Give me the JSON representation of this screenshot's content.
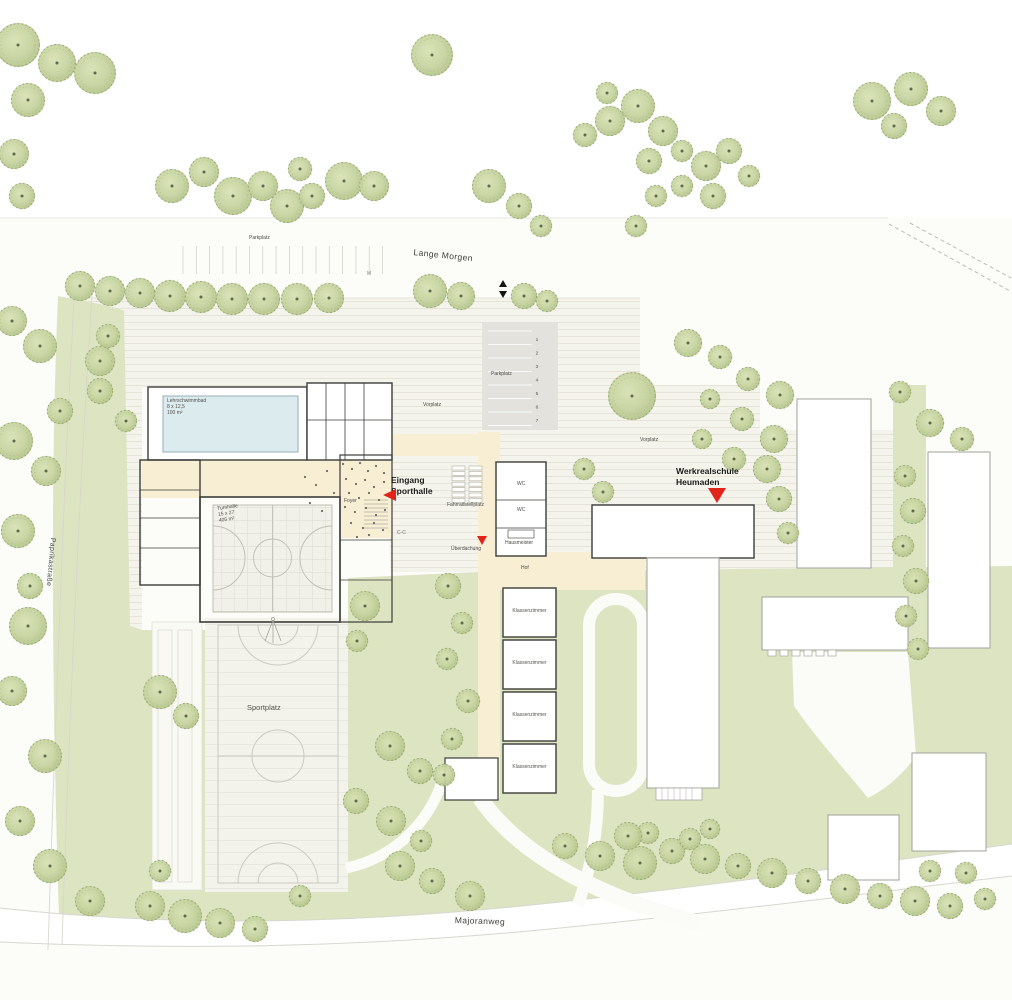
{
  "streets": {
    "top": "Lange Morgen",
    "left": "Paprikastraße",
    "bottom": "Majoranweg"
  },
  "areas": {
    "parking_top": "Parkplatz",
    "parking_school": "Parkplatz",
    "parking_stalls": [
      "1",
      "2",
      "3",
      "4",
      "5",
      "6",
      "7"
    ],
    "forecourt_west": "Vorplatz",
    "forecourt_east": "Vorplatz",
    "sports_field": "Sportplatz",
    "bike_parking": "Fahrradstellplatz",
    "canopy": "Überdachung",
    "courtyard": "Hof",
    "marker_m": "M",
    "section_mark": "C-C"
  },
  "sports_hall": {
    "entrance_line1": "Eingang",
    "entrance_line2": "Sporthalle",
    "foyer": "Foyer",
    "pool_line1": "Lehrschwimmbad",
    "pool_line2": "8 x 12,5",
    "pool_line3": "100 m²",
    "hall_line1": "Turnhalle",
    "hall_line2": "15 x 27",
    "hall_line3": "405 m²"
  },
  "school": {
    "name_line1": "Werkrealschule",
    "name_line2": "Heumaden",
    "wc": "WC",
    "caretaker": "Hausmeister",
    "classroom": "Klassenzimmer"
  },
  "colors": {
    "accent_red": "#e2231a",
    "lawn": "#dde4c2",
    "tree": "#c7d4a0",
    "water": "#dcebee",
    "path_cream": "#f8eed4",
    "paving": "#f4f3ec",
    "parking_gray": "#e3e2dd",
    "wall_dark": "#3c3c3a",
    "existing_outline": "#a9a8a2"
  },
  "trees": [
    [
      18,
      45,
      22
    ],
    [
      57,
      63,
      19
    ],
    [
      95,
      73,
      21
    ],
    [
      28,
      100,
      17
    ],
    [
      14,
      154,
      15
    ],
    [
      22,
      196,
      13
    ],
    [
      172,
      186,
      17
    ],
    [
      204,
      172,
      15
    ],
    [
      233,
      196,
      19
    ],
    [
      263,
      186,
      15
    ],
    [
      287,
      206,
      17
    ],
    [
      312,
      196,
      13
    ],
    [
      344,
      181,
      19
    ],
    [
      374,
      186,
      15
    ],
    [
      300,
      169,
      12
    ],
    [
      432,
      55,
      21
    ],
    [
      489,
      186,
      17
    ],
    [
      519,
      206,
      13
    ],
    [
      541,
      226,
      11
    ],
    [
      610,
      121,
      15
    ],
    [
      638,
      106,
      17
    ],
    [
      663,
      131,
      15
    ],
    [
      649,
      161,
      13
    ],
    [
      682,
      151,
      11
    ],
    [
      706,
      166,
      15
    ],
    [
      729,
      151,
      13
    ],
    [
      749,
      176,
      11
    ],
    [
      713,
      196,
      13
    ],
    [
      682,
      186,
      11
    ],
    [
      656,
      196,
      11
    ],
    [
      636,
      226,
      11
    ],
    [
      607,
      93,
      11
    ],
    [
      585,
      135,
      12
    ],
    [
      872,
      101,
      19
    ],
    [
      911,
      89,
      17
    ],
    [
      941,
      111,
      15
    ],
    [
      894,
      126,
      13
    ],
    [
      80,
      286,
      15
    ],
    [
      110,
      291,
      15
    ],
    [
      140,
      293,
      15
    ],
    [
      170,
      296,
      16
    ],
    [
      201,
      297,
      16
    ],
    [
      232,
      299,
      16
    ],
    [
      264,
      299,
      16
    ],
    [
      297,
      299,
      16
    ],
    [
      329,
      298,
      15
    ],
    [
      430,
      291,
      17
    ],
    [
      461,
      296,
      14
    ],
    [
      524,
      296,
      13
    ],
    [
      547,
      301,
      11
    ],
    [
      12,
      321,
      15
    ],
    [
      40,
      346,
      17
    ],
    [
      100,
      361,
      15
    ],
    [
      108,
      336,
      12
    ],
    [
      14,
      441,
      19
    ],
    [
      46,
      471,
      15
    ],
    [
      60,
      411,
      13
    ],
    [
      18,
      531,
      17
    ],
    [
      30,
      586,
      13
    ],
    [
      28,
      626,
      19
    ],
    [
      12,
      691,
      15
    ],
    [
      45,
      756,
      17
    ],
    [
      20,
      821,
      15
    ],
    [
      50,
      866,
      17
    ],
    [
      90,
      901,
      15
    ],
    [
      100,
      391,
      13
    ],
    [
      126,
      421,
      11
    ],
    [
      365,
      606,
      15
    ],
    [
      357,
      641,
      11
    ],
    [
      160,
      692,
      17
    ],
    [
      186,
      716,
      13
    ],
    [
      390,
      746,
      15
    ],
    [
      420,
      771,
      13
    ],
    [
      356,
      801,
      13
    ],
    [
      391,
      821,
      15
    ],
    [
      421,
      841,
      11
    ],
    [
      448,
      586,
      13
    ],
    [
      462,
      623,
      11
    ],
    [
      447,
      659,
      11
    ],
    [
      468,
      701,
      12
    ],
    [
      452,
      739,
      11
    ],
    [
      444,
      775,
      11
    ],
    [
      632,
      396,
      24
    ],
    [
      584,
      469,
      11
    ],
    [
      603,
      492,
      11
    ],
    [
      688,
      343,
      14
    ],
    [
      720,
      357,
      12
    ],
    [
      748,
      379,
      12
    ],
    [
      780,
      395,
      14
    ],
    [
      710,
      399,
      10
    ],
    [
      742,
      419,
      12
    ],
    [
      774,
      439,
      14
    ],
    [
      702,
      439,
      10
    ],
    [
      734,
      459,
      12
    ],
    [
      767,
      469,
      14
    ],
    [
      930,
      423,
      14
    ],
    [
      962,
      439,
      12
    ],
    [
      900,
      392,
      11
    ],
    [
      905,
      476,
      11
    ],
    [
      913,
      511,
      13
    ],
    [
      903,
      546,
      11
    ],
    [
      916,
      581,
      13
    ],
    [
      906,
      616,
      11
    ],
    [
      918,
      649,
      11
    ],
    [
      779,
      499,
      13
    ],
    [
      788,
      533,
      11
    ],
    [
      150,
      906,
      15
    ],
    [
      185,
      916,
      17
    ],
    [
      220,
      923,
      15
    ],
    [
      255,
      929,
      13
    ],
    [
      160,
      871,
      11
    ],
    [
      300,
      896,
      11
    ],
    [
      400,
      866,
      15
    ],
    [
      432,
      881,
      13
    ],
    [
      470,
      896,
      15
    ],
    [
      565,
      846,
      13
    ],
    [
      600,
      856,
      15
    ],
    [
      640,
      863,
      17
    ],
    [
      672,
      851,
      13
    ],
    [
      705,
      859,
      15
    ],
    [
      648,
      833,
      11
    ],
    [
      628,
      836,
      14
    ],
    [
      690,
      839,
      11
    ],
    [
      710,
      829,
      10
    ],
    [
      738,
      866,
      13
    ],
    [
      772,
      873,
      15
    ],
    [
      808,
      881,
      13
    ],
    [
      845,
      889,
      15
    ],
    [
      880,
      896,
      13
    ],
    [
      915,
      901,
      15
    ],
    [
      950,
      906,
      13
    ],
    [
      985,
      899,
      11
    ],
    [
      930,
      871,
      11
    ],
    [
      966,
      873,
      11
    ]
  ],
  "crowd_dots": [
    [
      343,
      464
    ],
    [
      352,
      469
    ],
    [
      360,
      463
    ],
    [
      368,
      471
    ],
    [
      376,
      466
    ],
    [
      384,
      473
    ],
    [
      346,
      479
    ],
    [
      356,
      484
    ],
    [
      365,
      480
    ],
    [
      374,
      487
    ],
    [
      384,
      482
    ],
    [
      349,
      493
    ],
    [
      359,
      498
    ],
    [
      369,
      493
    ],
    [
      379,
      500
    ],
    [
      387,
      495
    ],
    [
      345,
      507
    ],
    [
      355,
      512
    ],
    [
      366,
      508
    ],
    [
      376,
      515
    ],
    [
      385,
      510
    ],
    [
      351,
      523
    ],
    [
      363,
      528
    ],
    [
      374,
      523
    ],
    [
      383,
      530
    ],
    [
      357,
      537
    ],
    [
      369,
      535
    ],
    [
      305,
      477
    ],
    [
      316,
      485
    ],
    [
      327,
      471
    ],
    [
      334,
      493
    ],
    [
      310,
      503
    ],
    [
      322,
      511
    ]
  ]
}
